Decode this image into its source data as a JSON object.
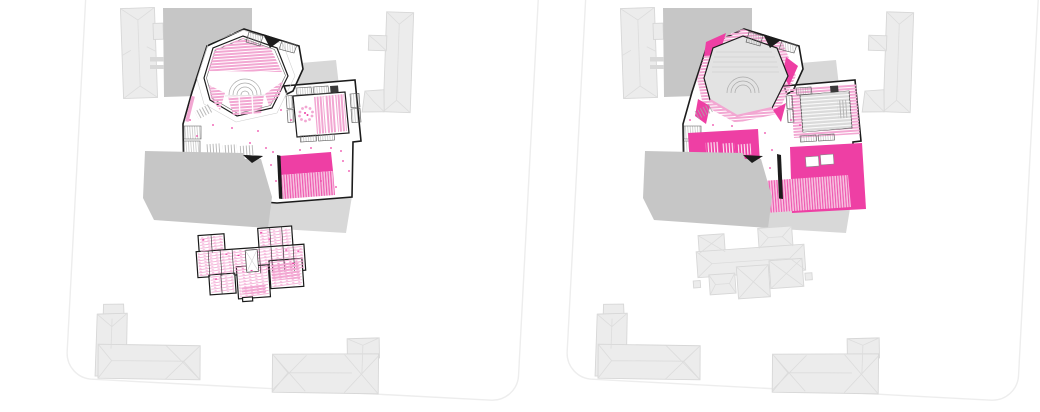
{
  "page": {
    "background": "#ffffff"
  },
  "colors": {
    "wall": "#1c1c1c",
    "seat_pink": "#f2a7d2",
    "seat_pink_light": "#f7c3e1",
    "magenta": "#ee3fa4",
    "context_fill": "#ececec",
    "context_stroke": "#d7d7d7",
    "ridge": "#dcdcdc",
    "mass_dark": "#c6c6c6",
    "mass_light": "#d8d8d8",
    "hall_floor": "#e3e3e3",
    "inner_hall_gray": "#dadada",
    "boundary": "#ededed",
    "detail_gray": "#b9b9b9"
  },
  "panels": [
    {
      "name": "site-plan-left"
    },
    {
      "name": "site-plan-right"
    }
  ]
}
